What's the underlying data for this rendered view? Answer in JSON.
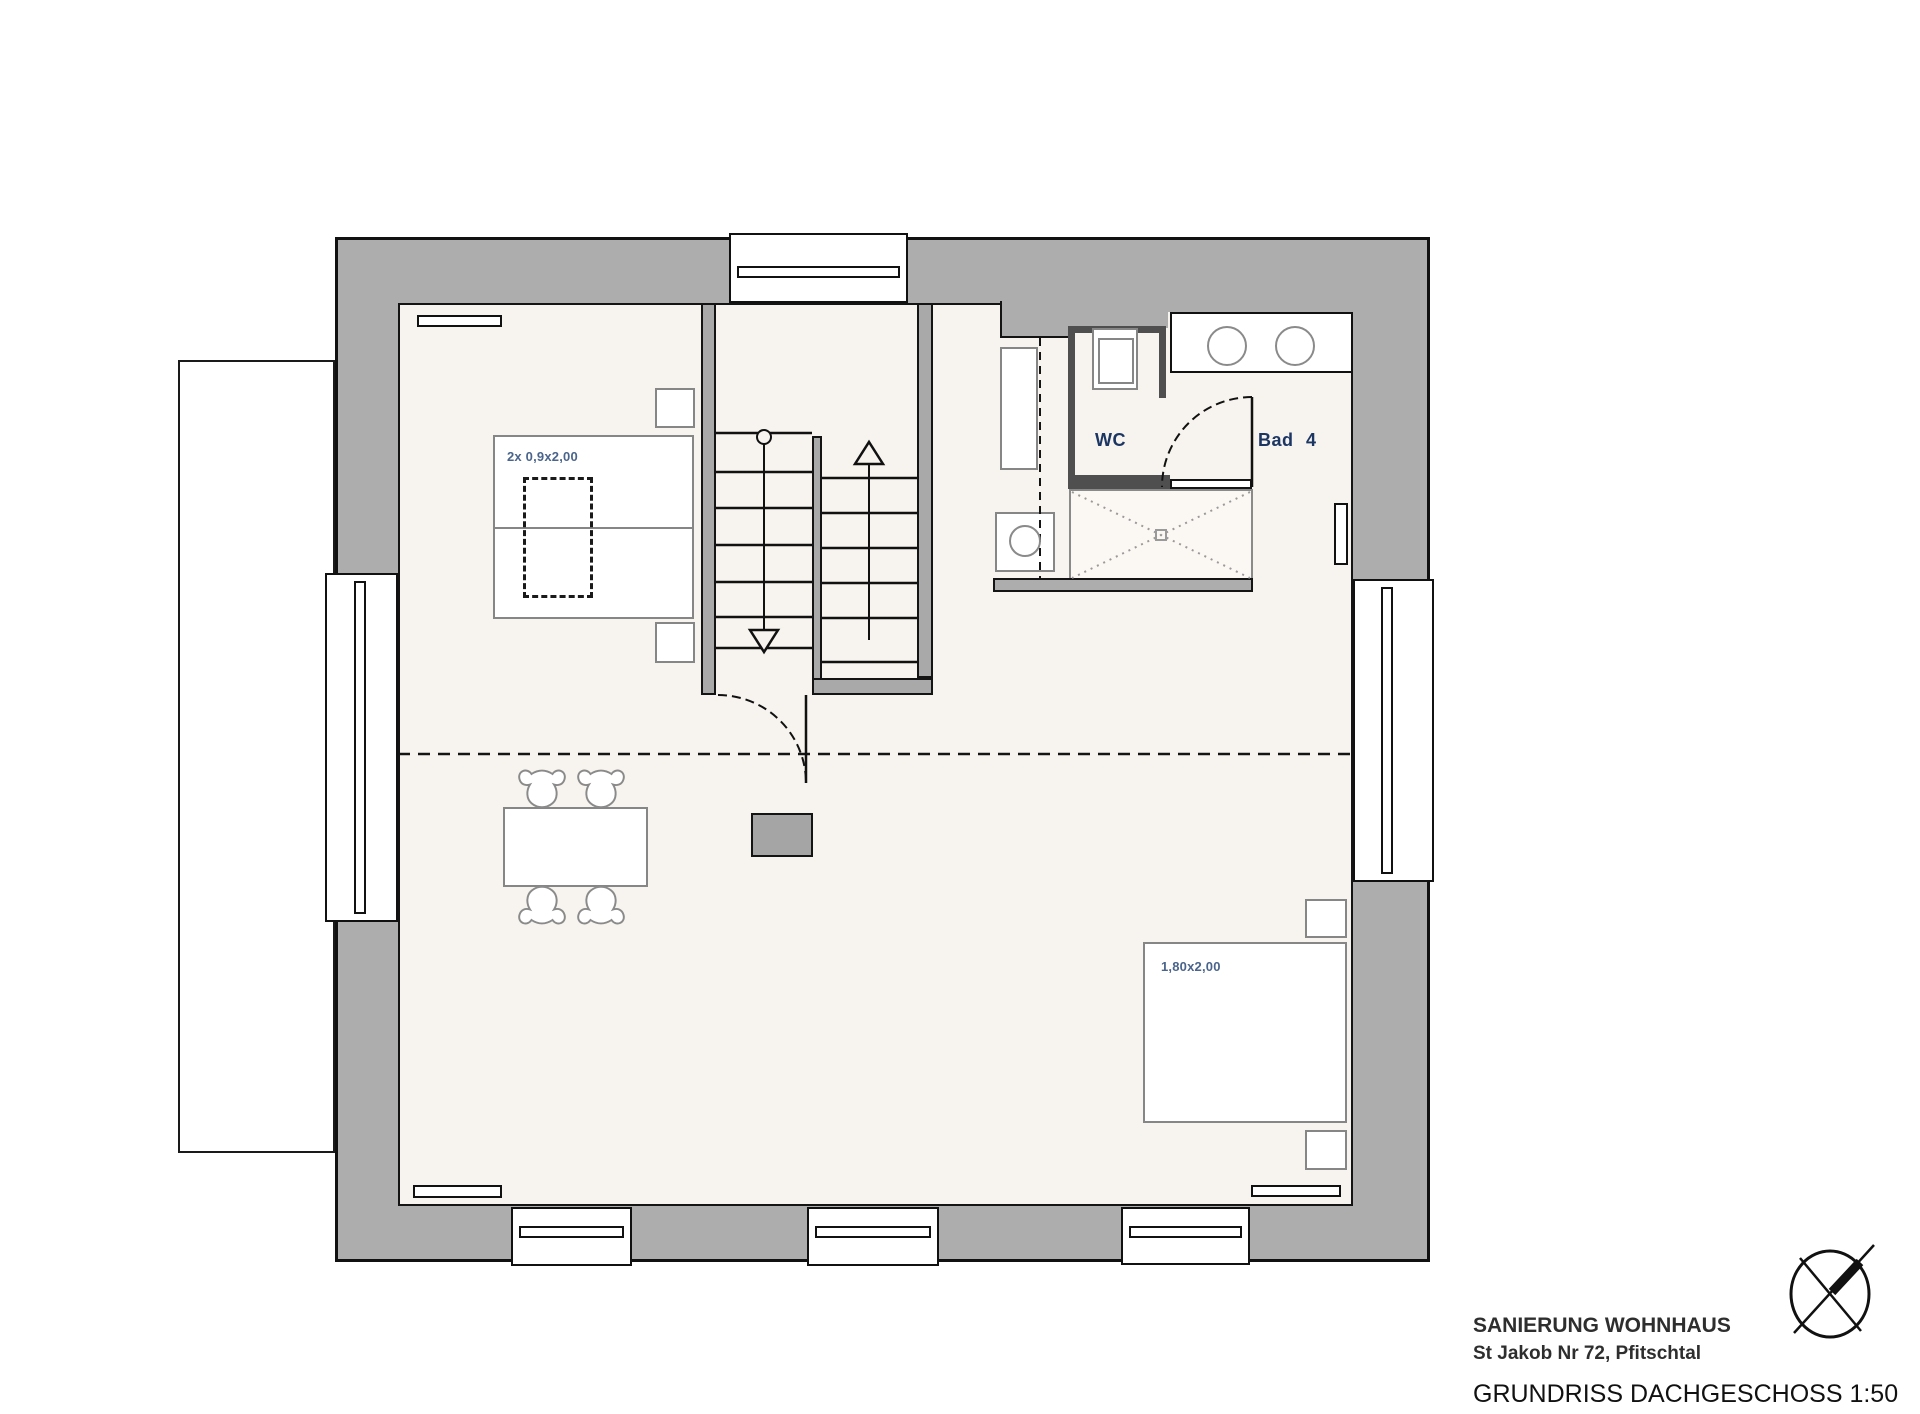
{
  "plan": {
    "labels": {
      "wc": "WC",
      "bad": "Bad 4",
      "bed_small": "2x 0,9x2,00",
      "bed_large": "1,80x2,00"
    },
    "title_block": {
      "line1": "SANIERUNG WOHNHAUS",
      "line2": "St Jakob Nr 72, Pfitschtal",
      "line3": "GRUNDRISS DACHGESCHOSS 1:50"
    },
    "scale": "1:50",
    "colors": {
      "wall_fill": "#adadad",
      "floor_fill": "#f7f3ee",
      "outline": "#111111",
      "wc_wall": "#4f4f4f",
      "furniture_outline": "#868686",
      "room_label": "#1c3664",
      "dim_label": "#4a648c"
    },
    "icons": {
      "north_arrow": "north-arrow-icon"
    }
  }
}
